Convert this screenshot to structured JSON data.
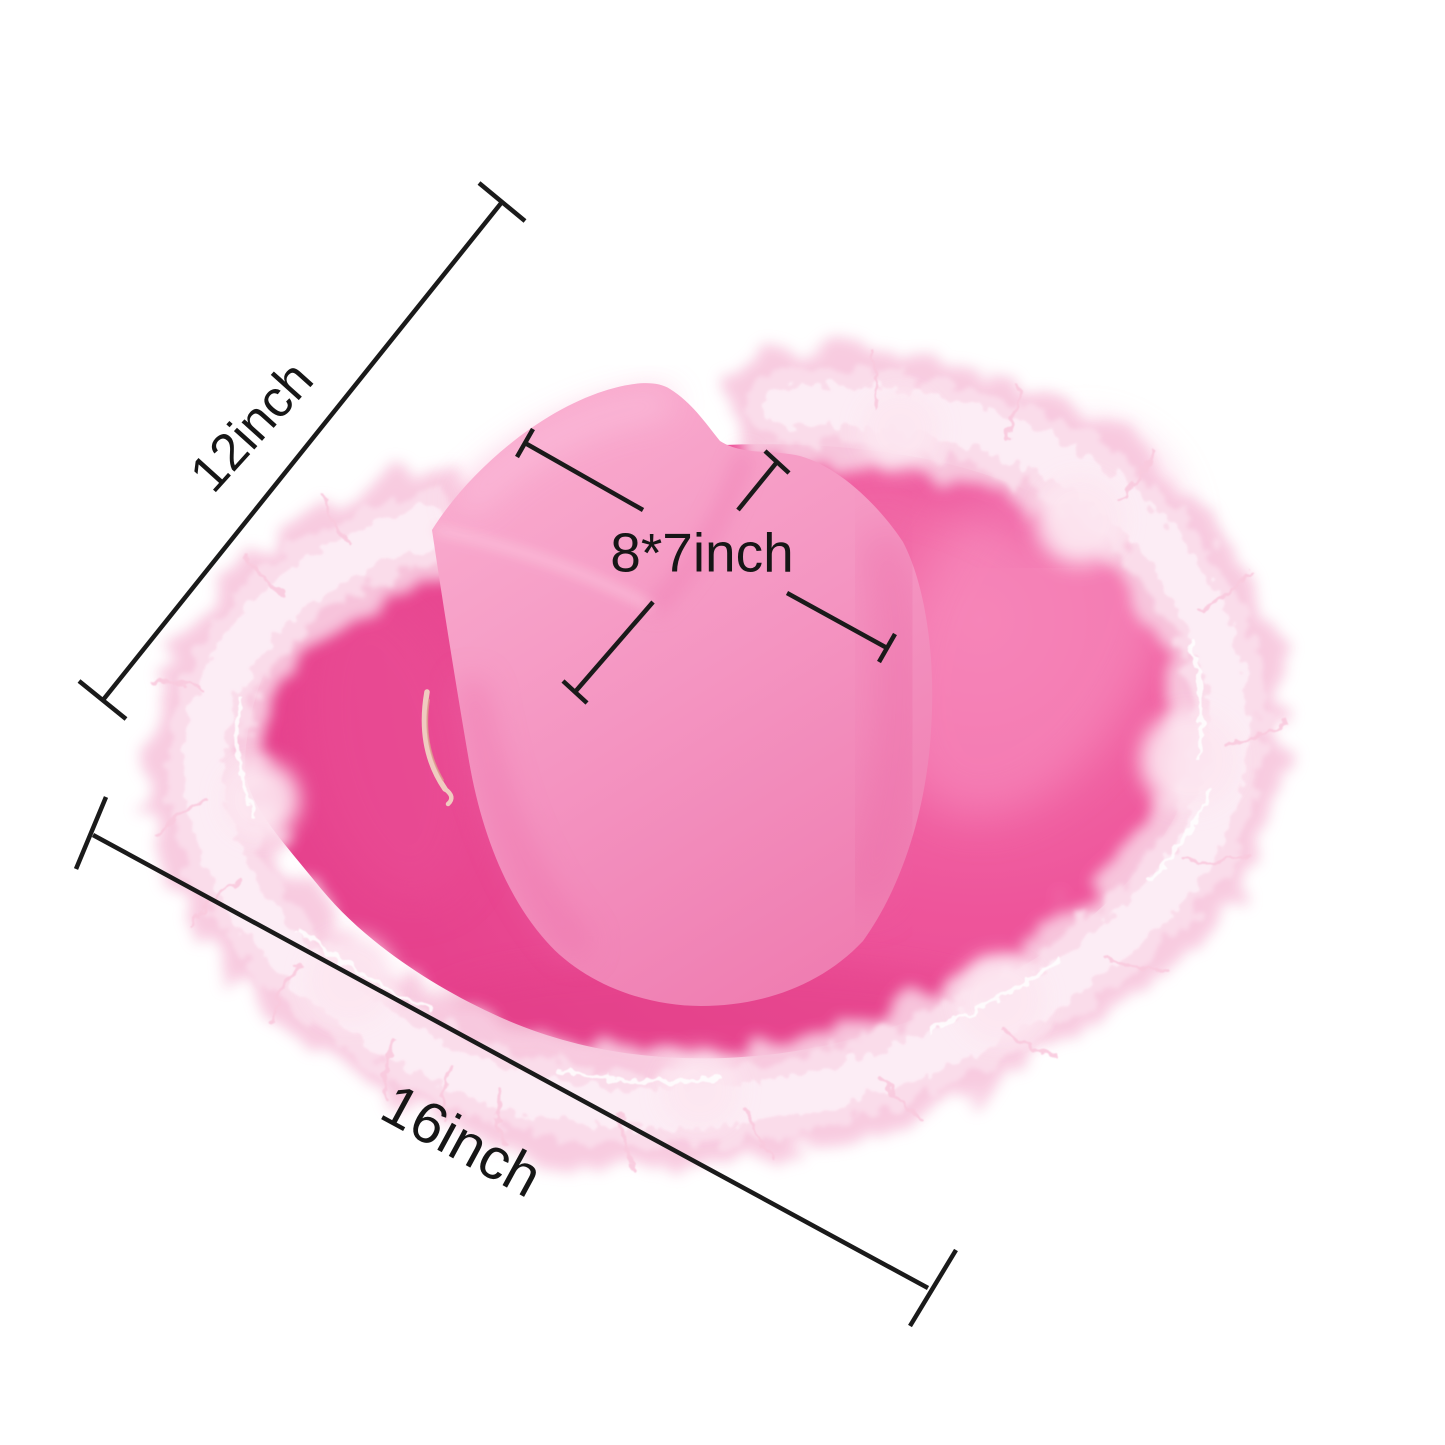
{
  "meta": {
    "type": "product-dimension-photo",
    "background_color": "#ffffff",
    "subject": "Pink feather-trim cowboy hat with measurement annotations"
  },
  "hat": {
    "crown_color": "#f494c1",
    "crown_highlight": "#f9abce",
    "brim_color": "#ee559b",
    "brim_shadow": "#e6428d",
    "feather_color": "#f8c9df",
    "feather_highlight": "#fdeef6",
    "cord_color": "#f0cbc0"
  },
  "annotations": {
    "line_color": "#1a1a1a",
    "labels": {
      "left_diagonal": "12inch",
      "bottom": "16inch",
      "crown": "8*7inch"
    }
  }
}
